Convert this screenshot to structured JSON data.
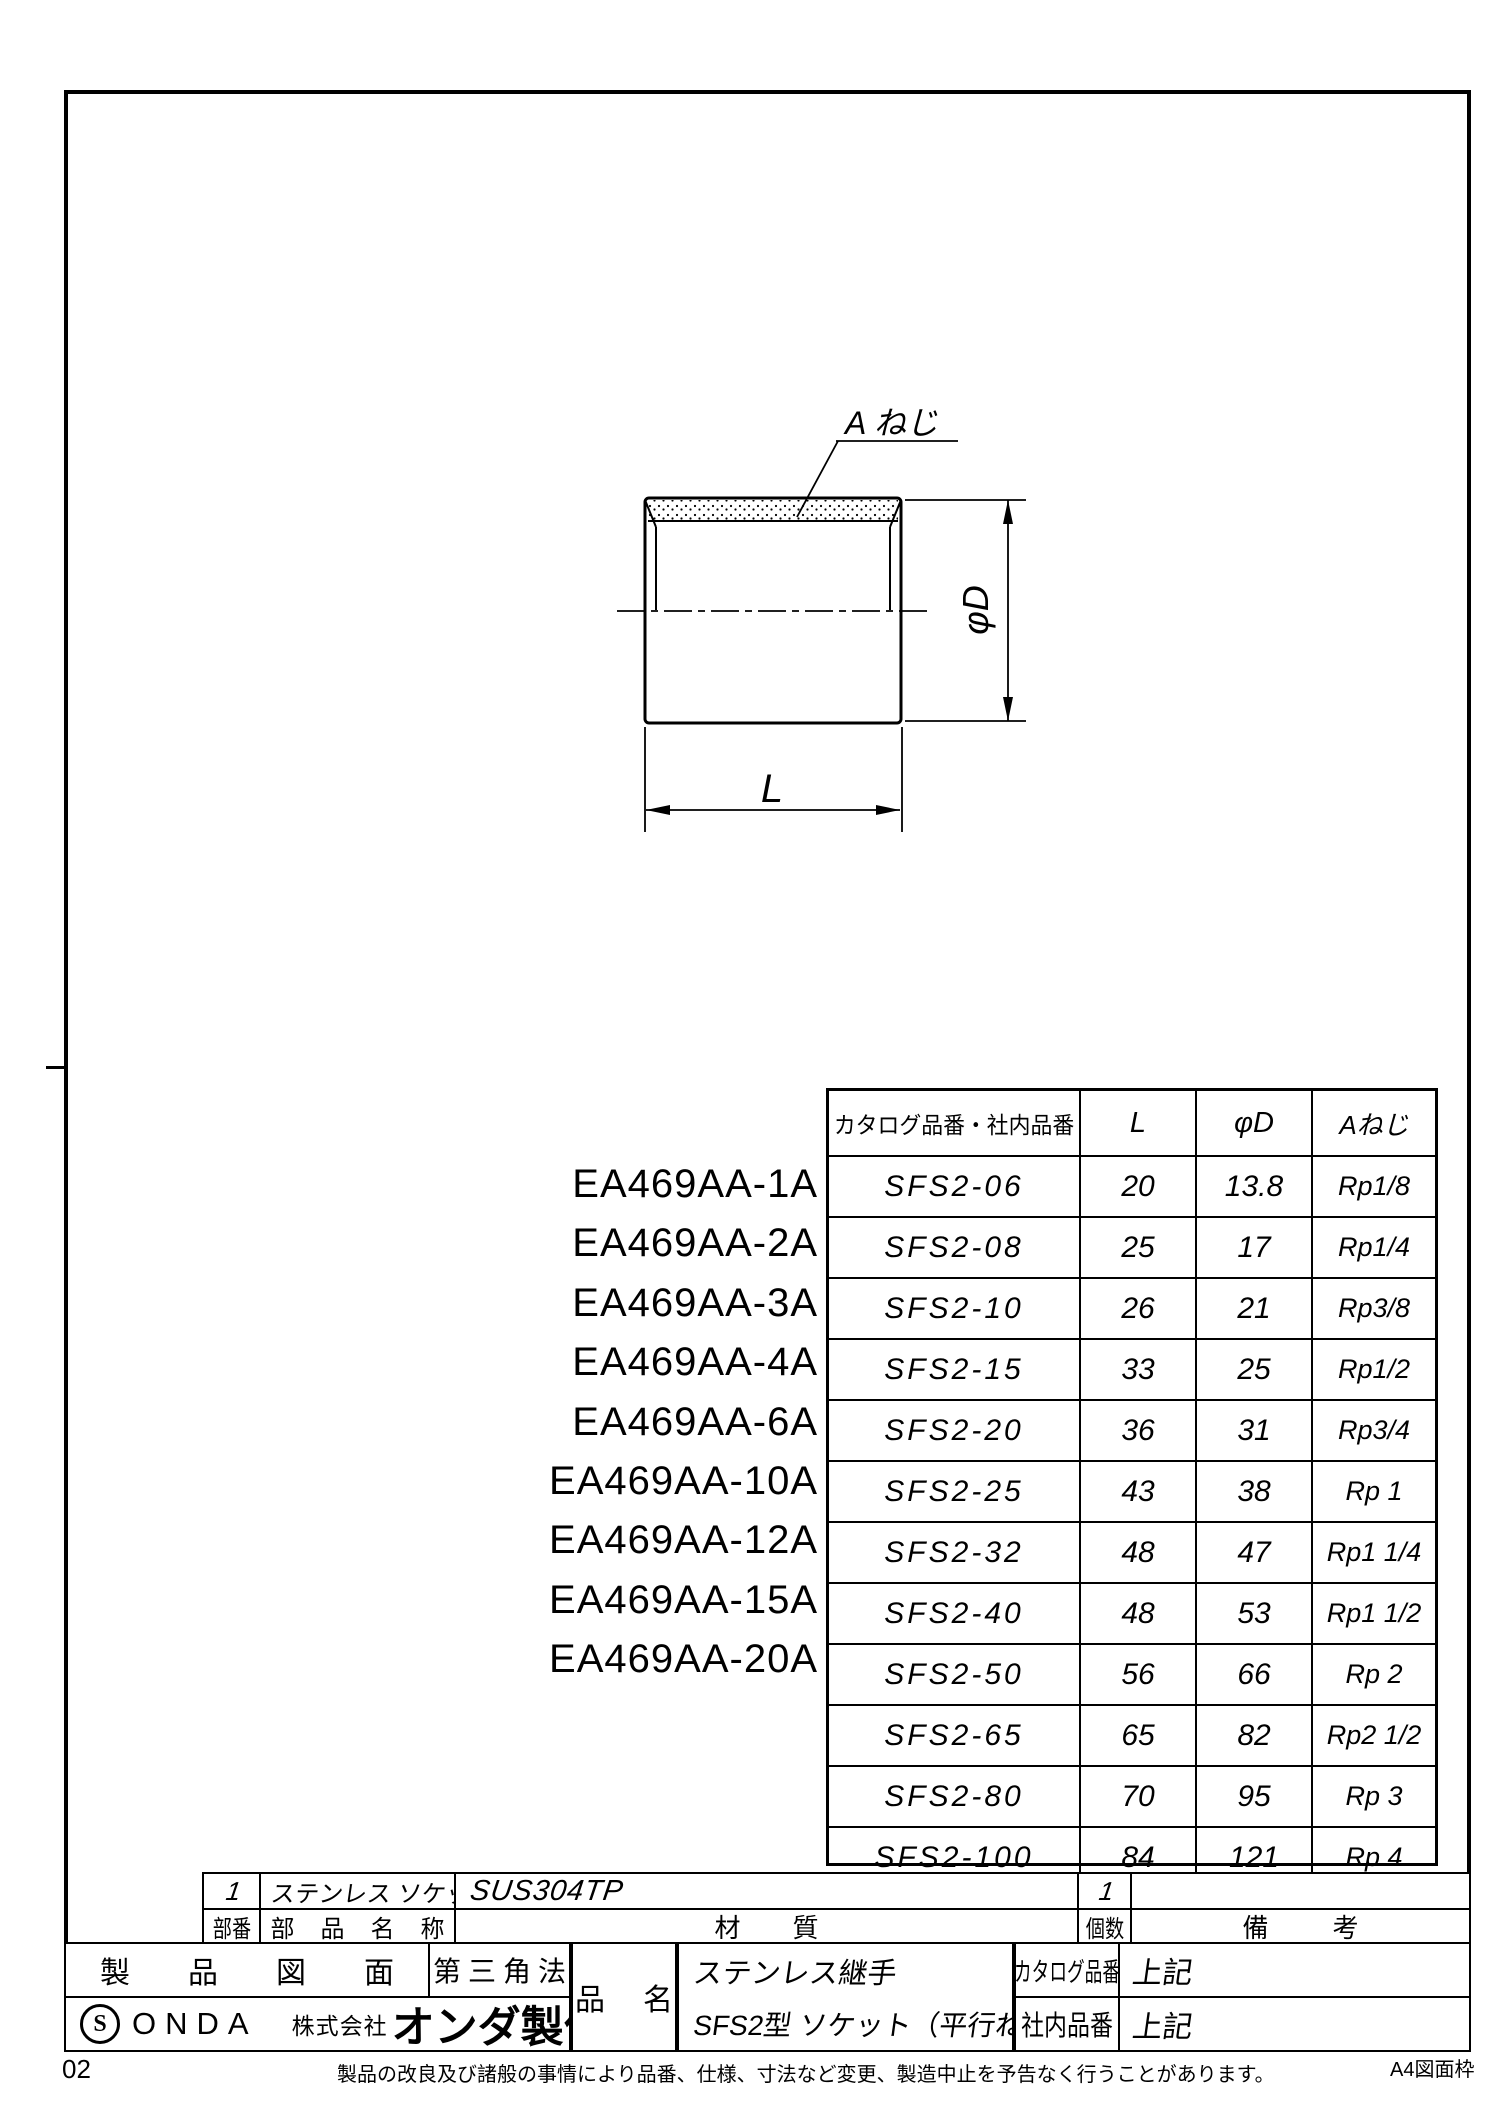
{
  "drawing": {
    "thread_label": "A ねじ",
    "dim_diameter": "φD",
    "dim_length": "L"
  },
  "ea_codes": [
    "EA469AA-1A",
    "EA469AA-2A",
    "EA469AA-3A",
    "EA469AA-4A",
    "EA469AA-6A",
    "EA469AA-10A",
    "EA469AA-12A",
    "EA469AA-15A",
    "EA469AA-20A"
  ],
  "table": {
    "headers": [
      "カタログ品番・社内品番",
      "L",
      "φD",
      "Aねじ"
    ],
    "rows": [
      {
        "code": "SFS2-06",
        "L": "20",
        "D": "13.8",
        "thread": "Rp1/8"
      },
      {
        "code": "SFS2-08",
        "L": "25",
        "D": "17",
        "thread": "Rp1/4"
      },
      {
        "code": "SFS2-10",
        "L": "26",
        "D": "21",
        "thread": "Rp3/8"
      },
      {
        "code": "SFS2-15",
        "L": "33",
        "D": "25",
        "thread": "Rp1/2"
      },
      {
        "code": "SFS2-20",
        "L": "36",
        "D": "31",
        "thread": "Rp3/4"
      },
      {
        "code": "SFS2-25",
        "L": "43",
        "D": "38",
        "thread": "Rp 1"
      },
      {
        "code": "SFS2-32",
        "L": "48",
        "D": "47",
        "thread": "Rp1 1/4"
      },
      {
        "code": "SFS2-40",
        "L": "48",
        "D": "53",
        "thread": "Rp1 1/2"
      },
      {
        "code": "SFS2-50",
        "L": "56",
        "D": "66",
        "thread": "Rp 2"
      },
      {
        "code": "SFS2-65",
        "L": "65",
        "D": "82",
        "thread": "Rp2 1/2"
      },
      {
        "code": "SFS2-80",
        "L": "70",
        "D": "95",
        "thread": "Rp 3"
      },
      {
        "code": "SFS2-100",
        "L": "84",
        "D": "121",
        "thread": "Rp 4"
      }
    ]
  },
  "parts_list": {
    "row": {
      "part_no": "1",
      "name": "ステンレス ソケット（平行ねじ）",
      "material": "SUS304TP",
      "qty": "1",
      "remarks": ""
    },
    "headers": {
      "part_no": "部番",
      "name": "部品名称",
      "material": "材質",
      "qty": "個数",
      "remarks": "備考"
    }
  },
  "title_block": {
    "doc_type": "製品図面",
    "projection": "第三角法",
    "logo_s": "S",
    "logo_onda": "ONDA",
    "company_prefix": "株式会社",
    "company_name": "オンダ製作所",
    "item_label": "品名",
    "item_line1": "ステンレス継手",
    "item_line2": "SFS2型 ソケット（平行ねじ）",
    "catalog_label": "カタログ品番",
    "catalog_value": "上記",
    "internal_label": "社内品番",
    "internal_value": "上記"
  },
  "footer": {
    "page_number": "02",
    "disclaimer": "製品の改良及び諸般の事情により品番、仕様、寸法など変更、製造中止を予告なく行うことがあります。",
    "frame_label": "A4図面枠"
  }
}
